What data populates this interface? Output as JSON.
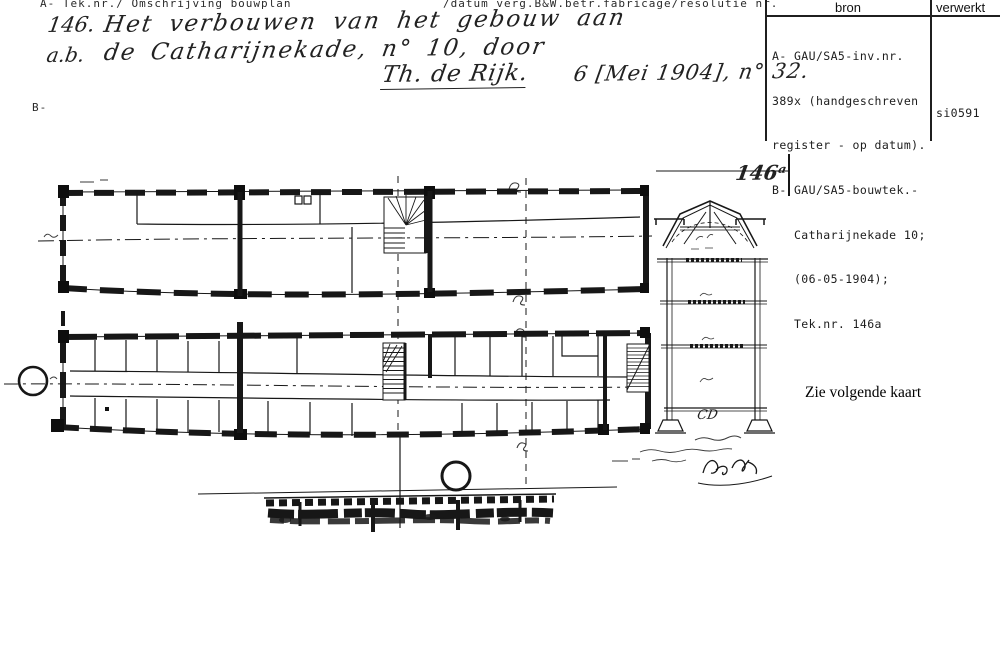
{
  "header": {
    "tek_label": "A- Tek.nr./ Omschrijving bouwplan",
    "datum_label": "/datum verg.B&W.betr.fabricage/resolutie nr.",
    "b_label": "B-"
  },
  "source_table": {
    "col_bron": "bron",
    "col_verwerkt": "verwerkt",
    "bron_lines": [
      "A- GAU/SA5-inv.nr.",
      "389x (handgeschreven",
      "register - op datum).",
      "B- GAU/SA5-bouwtek.-",
      "   Catharijnekade 10;",
      "   (06-05-1904);",
      "   Tek.nr. 146a"
    ],
    "verwerkt_value": "si0591"
  },
  "handwriting": {
    "number": "146.",
    "line1": "Het verbouwen van het gebouw aan",
    "prefix2": "a.b.",
    "line2": "de Catharijnekade, n° 10, door",
    "name": "Th. de Rijk.",
    "date": "6 [Mei 1904], n° 32."
  },
  "drawing": {
    "sheet_number": "146ᵃ",
    "section_label": "CD",
    "note": "Zie volgende kaart"
  },
  "colors": {
    "ink": "#171717",
    "paper": "#ffffff"
  }
}
